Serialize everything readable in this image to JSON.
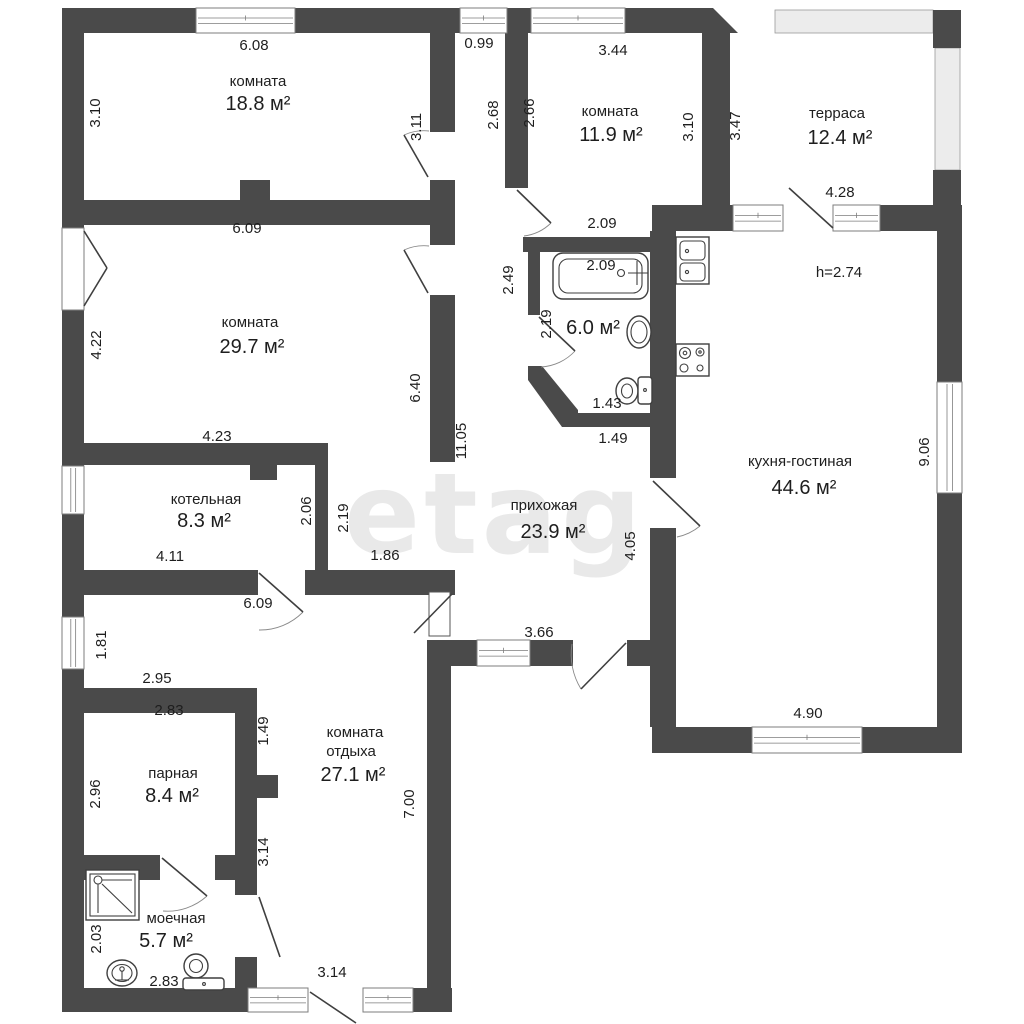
{
  "watermark": "etagi",
  "texts": [
    {
      "t": "6.08",
      "x": 254,
      "y": 50,
      "name": "dim-bedroom1-top"
    },
    {
      "t": "комната",
      "x": 258,
      "y": 86,
      "name": "room-label-bedroom1"
    },
    {
      "t": "18.8 м²",
      "x": 258,
      "y": 110,
      "size": 20,
      "name": "area-bedroom1"
    },
    {
      "t": "3.10",
      "x": 100,
      "y": 113,
      "rot": -90,
      "name": "dim-bedroom1-left"
    },
    {
      "t": "3.11",
      "x": 421,
      "y": 127,
      "rot": -90,
      "name": "dim-bedroom1-right"
    },
    {
      "t": "0.99",
      "x": 479,
      "y": 48,
      "name": "dim-corridor-top"
    },
    {
      "t": "2.68",
      "x": 498,
      "y": 115,
      "rot": -90,
      "name": "dim-corridor-left"
    },
    {
      "t": "2.66",
      "x": 534,
      "y": 113,
      "rot": -90,
      "name": "dim-bedroom2-left"
    },
    {
      "t": "комната",
      "x": 610,
      "y": 116,
      "name": "room-label-bedroom2"
    },
    {
      "t": "11.9 м²",
      "x": 611,
      "y": 141,
      "size": 20,
      "name": "area-bedroom2"
    },
    {
      "t": "3.44",
      "x": 613,
      "y": 55,
      "name": "dim-bedroom2-top"
    },
    {
      "t": "3.10",
      "x": 693,
      "y": 127,
      "rot": -90,
      "name": "dim-bedroom2-right"
    },
    {
      "t": "2.09",
      "x": 602,
      "y": 228,
      "name": "dim-bedroom2-bottom"
    },
    {
      "t": "терраса",
      "x": 837,
      "y": 118,
      "name": "room-label-terrace"
    },
    {
      "t": "12.4 м²",
      "x": 840,
      "y": 144,
      "size": 20,
      "name": "area-terrace"
    },
    {
      "t": "3.47",
      "x": 740,
      "y": 126,
      "rot": -90,
      "name": "dim-terrace-left"
    },
    {
      "t": "4.28",
      "x": 840,
      "y": 197,
      "name": "dim-terrace-bottom"
    },
    {
      "t": "h=2.74",
      "x": 839,
      "y": 277,
      "name": "ceiling-height"
    },
    {
      "t": "кухня-гостиная",
      "x": 800,
      "y": 466,
      "name": "room-label-kitchen"
    },
    {
      "t": "44.6 м²",
      "x": 804,
      "y": 494,
      "size": 20,
      "name": "area-kitchen"
    },
    {
      "t": "9.06",
      "x": 929,
      "y": 452,
      "rot": -90,
      "name": "dim-kitchen-right"
    },
    {
      "t": "4.90",
      "x": 808,
      "y": 718,
      "name": "dim-kitchen-bottom"
    },
    {
      "t": "6.09",
      "x": 247,
      "y": 233,
      "name": "dim-bedroom3-top"
    },
    {
      "t": "комната",
      "x": 250,
      "y": 327,
      "name": "room-label-bedroom3"
    },
    {
      "t": "29.7 м²",
      "x": 252,
      "y": 353,
      "size": 20,
      "name": "area-bedroom3"
    },
    {
      "t": "4.22",
      "x": 101,
      "y": 345,
      "rot": -90,
      "name": "dim-bedroom3-left"
    },
    {
      "t": "6.40",
      "x": 420,
      "y": 388,
      "rot": -90,
      "name": "dim-bedroom3-right"
    },
    {
      "t": "11.05",
      "x": 466,
      "y": 441,
      "rot": -90,
      "name": "dim-hallway-left"
    },
    {
      "t": "4.23",
      "x": 217,
      "y": 441,
      "name": "dim-boiler-top"
    },
    {
      "t": "котельная",
      "x": 206,
      "y": 504,
      "name": "room-label-boiler"
    },
    {
      "t": "8.3 м²",
      "x": 204,
      "y": 527,
      "size": 20,
      "name": "area-boiler"
    },
    {
      "t": "2.06",
      "x": 311,
      "y": 511,
      "rot": -90,
      "name": "dim-boiler-right"
    },
    {
      "t": "2.19",
      "x": 348,
      "y": 518,
      "rot": -90,
      "name": "dim-nook-left"
    },
    {
      "t": "4.11",
      "x": 170,
      "y": 561,
      "name": "dim-boiler-bottom"
    },
    {
      "t": "1.86",
      "x": 385,
      "y": 560,
      "name": "dim-nook-bottom"
    },
    {
      "t": "2.49",
      "x": 513,
      "y": 280,
      "rot": -90,
      "name": "dim-bath-outer"
    },
    {
      "t": "2.09",
      "x": 601,
      "y": 270,
      "name": "dim-bathtub"
    },
    {
      "t": "2.19",
      "x": 551,
      "y": 324,
      "rot": -90,
      "name": "dim-bath-left"
    },
    {
      "t": "6.0 м²",
      "x": 593,
      "y": 334,
      "size": 20,
      "name": "area-bathroom"
    },
    {
      "t": "1.43",
      "x": 607,
      "y": 408,
      "name": "dim-bath-bottom"
    },
    {
      "t": "1.49",
      "x": 613,
      "y": 443,
      "name": "dim-bath-below"
    },
    {
      "t": "прихожая",
      "x": 544,
      "y": 510,
      "name": "room-label-hallway"
    },
    {
      "t": "23.9 м²",
      "x": 553,
      "y": 538,
      "size": 20,
      "name": "area-hallway"
    },
    {
      "t": "4.05",
      "x": 635,
      "y": 546,
      "rot": -90,
      "name": "dim-hallway-right"
    },
    {
      "t": "3.66",
      "x": 539,
      "y": 637,
      "name": "dim-hallway-bottom"
    },
    {
      "t": "6.09",
      "x": 258,
      "y": 608,
      "name": "dim-lounge-top"
    },
    {
      "t": "1.81",
      "x": 106,
      "y": 645,
      "rot": -90,
      "name": "dim-hall-window"
    },
    {
      "t": "2.95",
      "x": 157,
      "y": 683,
      "name": "dim-sauna-outer"
    },
    {
      "t": "2.83",
      "x": 169,
      "y": 715,
      "name": "dim-sauna-top"
    },
    {
      "t": "1.49",
      "x": 268,
      "y": 731,
      "rot": -90,
      "name": "dim-lounge-notch"
    },
    {
      "t": "комната",
      "x": 355,
      "y": 737,
      "name": "room-label-lounge-1"
    },
    {
      "t": "отдыха",
      "x": 351,
      "y": 756,
      "name": "room-label-lounge-2"
    },
    {
      "t": "27.1 м²",
      "x": 353,
      "y": 781,
      "size": 20,
      "name": "area-lounge"
    },
    {
      "t": "7.00",
      "x": 414,
      "y": 804,
      "rot": -90,
      "name": "dim-lounge-right"
    },
    {
      "t": "парная",
      "x": 173,
      "y": 778,
      "name": "room-label-sauna"
    },
    {
      "t": "8.4 м²",
      "x": 172,
      "y": 802,
      "size": 20,
      "name": "area-sauna"
    },
    {
      "t": "2.96",
      "x": 100,
      "y": 794,
      "rot": -90,
      "name": "dim-sauna-left"
    },
    {
      "t": "3.14",
      "x": 268,
      "y": 852,
      "rot": -90,
      "name": "dim-sauna-right"
    },
    {
      "t": "моечная",
      "x": 176,
      "y": 923,
      "name": "room-label-washroom"
    },
    {
      "t": "5.7 м²",
      "x": 166,
      "y": 947,
      "size": 20,
      "name": "area-washroom"
    },
    {
      "t": "2.03",
      "x": 101,
      "y": 939,
      "rot": -90,
      "name": "dim-washroom-left"
    },
    {
      "t": "2.83",
      "x": 164,
      "y": 986,
      "name": "dim-washroom-bottom"
    },
    {
      "t": "3.14",
      "x": 332,
      "y": 977,
      "name": "dim-lounge-bottom"
    }
  ]
}
